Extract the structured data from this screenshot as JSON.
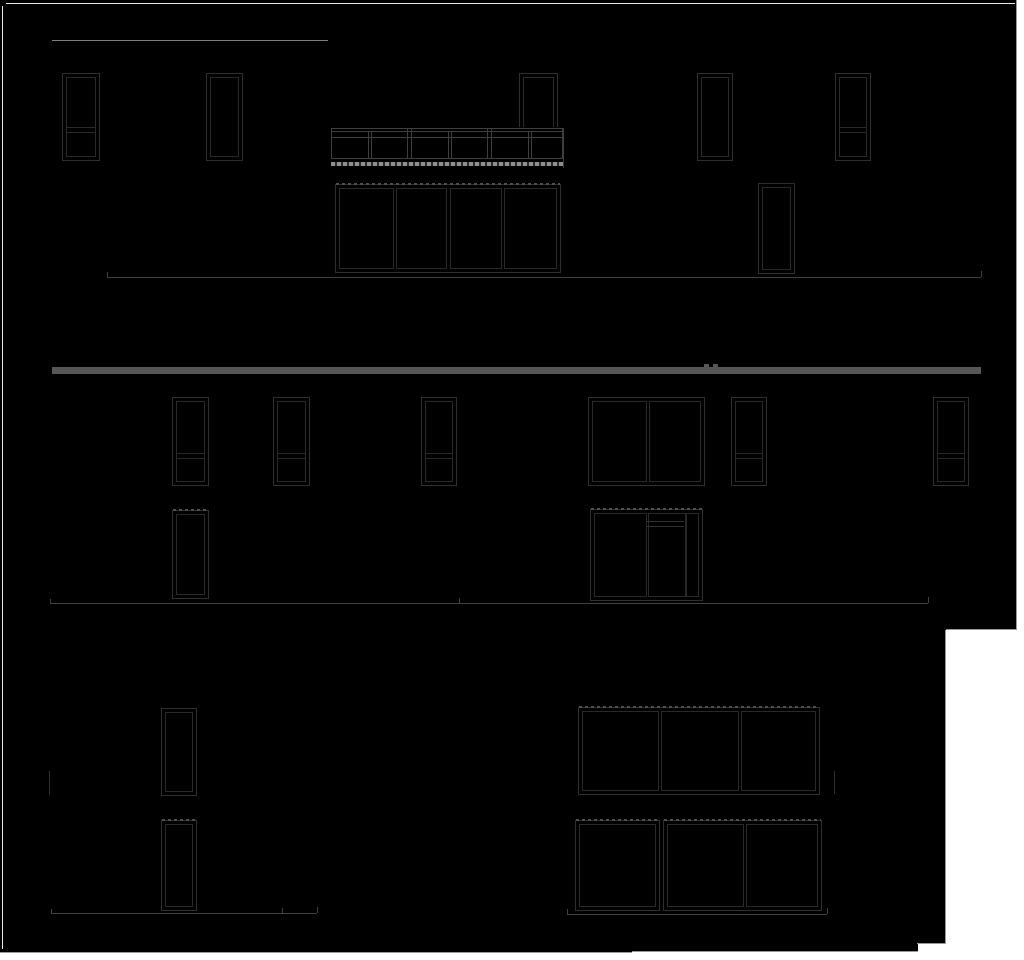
{
  "canvas": {
    "width": 1024,
    "height": 960,
    "page_bg": "#ffffff",
    "sheet_bg": "#000000"
  },
  "colors": {
    "frame": "#2f2f2f",
    "inner": "#292929",
    "ground": "#404040",
    "rail": "#3e3e3e",
    "bar": "#565656",
    "topline": "#7d7d7d",
    "border": "#e9e9e9",
    "edge": "#999999",
    "dash_light": "#8f8f8f",
    "dash_dark": "#2a2a2a",
    "hatch": "#4f4f4f"
  },
  "sheets": [
    {
      "name": "sheet-black-upper",
      "x": 0,
      "y": 0,
      "w": 1017,
      "h": 630
    },
    {
      "name": "sheet-black-lower",
      "x": 0,
      "y": 630,
      "w": 946,
      "h": 313
    },
    {
      "name": "sheet-black-lower-step1",
      "x": 0,
      "y": 943,
      "w": 918,
      "h": 9
    },
    {
      "name": "sheet-black-lower-step2",
      "x": 0,
      "y": 945,
      "w": 632,
      "h": 8
    }
  ],
  "page_edges": [
    {
      "name": "page-edge-right-upper",
      "type": "v",
      "x": 1016,
      "y": 0,
      "len": 630
    },
    {
      "name": "page-edge-bottom-upper",
      "type": "h",
      "x": 946,
      "y": 629,
      "len": 71
    },
    {
      "name": "page-edge-right-lower",
      "type": "v",
      "x": 945,
      "y": 630,
      "len": 313
    },
    {
      "name": "page-edge-step",
      "type": "h",
      "x": 917,
      "y": 943,
      "len": 29
    },
    {
      "name": "page-edge-bottom-strip",
      "type": "h",
      "x": 632,
      "y": 951,
      "len": 286
    },
    {
      "name": "page-edge-bottom-strip2",
      "type": "h",
      "x": 0,
      "y": 952,
      "len": 632
    }
  ],
  "sheet_border_lines": [
    {
      "name": "sheet-border-top",
      "type": "h",
      "x": 6,
      "y": 3,
      "len": 1009
    },
    {
      "name": "sheet-border-left",
      "type": "v",
      "x": 2,
      "y": 6,
      "len": 943
    }
  ],
  "elements": [
    {
      "type": "lineh",
      "name": "elev1-roof-line",
      "x": 52,
      "y": 40,
      "len": 276,
      "color": "topline"
    },
    {
      "type": "window",
      "name": "elev1-window-1",
      "x": 62,
      "y": 73,
      "w": 38,
      "h": 88,
      "transom": 0.6
    },
    {
      "type": "window",
      "name": "elev1-window-2",
      "x": 206,
      "y": 73,
      "w": 37,
      "h": 88
    },
    {
      "type": "window",
      "name": "elev1-window-behind-railing",
      "x": 519,
      "y": 73,
      "w": 39,
      "h": 88
    },
    {
      "type": "window",
      "name": "elev1-window-3",
      "x": 697,
      "y": 73,
      "w": 36,
      "h": 88
    },
    {
      "type": "window",
      "name": "elev1-window-4",
      "x": 835,
      "y": 73,
      "w": 36,
      "h": 88,
      "transom": 0.6
    },
    {
      "type": "railing",
      "name": "elev1-balcony-railing",
      "x": 331,
      "y": 127,
      "w": 233,
      "h": 41,
      "panels": 3
    },
    {
      "type": "window",
      "name": "elev1-sliding-door",
      "x": 335,
      "y": 184,
      "w": 226,
      "h": 89,
      "hatchTop": true,
      "mullions": [
        {
          "x": 57,
          "w": 4
        },
        {
          "x": 110,
          "w": 5
        },
        {
          "x": 165,
          "w": 4
        }
      ]
    },
    {
      "type": "window",
      "name": "elev1-door",
      "x": 758,
      "y": 183,
      "w": 37,
      "h": 91
    },
    {
      "type": "ground",
      "name": "elev1-ground-line",
      "x": 107,
      "y": 277,
      "len": 874,
      "ticks": [
        {
          "x": 0,
          "h": 5
        },
        {
          "x": 874,
          "h": 6
        }
      ]
    },
    {
      "type": "rect",
      "name": "elev2-parapet-bar",
      "x": 52,
      "y": 367,
      "w": 929,
      "h": 7,
      "color": "bar"
    },
    {
      "type": "rect",
      "name": "elev2-parapet-tab-1",
      "x": 704,
      "y": 364,
      "w": 5,
      "h": 3,
      "color": "bar"
    },
    {
      "type": "rect",
      "name": "elev2-parapet-tab-2",
      "x": 713,
      "y": 364,
      "w": 5,
      "h": 3,
      "color": "bar"
    },
    {
      "type": "window",
      "name": "elev2-window-1",
      "x": 172,
      "y": 397,
      "w": 37,
      "h": 89,
      "transom": 0.62
    },
    {
      "type": "window",
      "name": "elev2-window-2",
      "x": 273,
      "y": 397,
      "w": 37,
      "h": 89,
      "transom": 0.62
    },
    {
      "type": "window",
      "name": "elev2-window-3",
      "x": 421,
      "y": 397,
      "w": 36,
      "h": 89,
      "transom": 0.62
    },
    {
      "type": "window",
      "name": "elev2-double-window",
      "x": 588,
      "y": 397,
      "w": 117,
      "h": 89,
      "mullions": [
        {
          "x": 57,
          "w": 4
        }
      ]
    },
    {
      "type": "window",
      "name": "elev2-window-4",
      "x": 731,
      "y": 397,
      "w": 36,
      "h": 89,
      "transom": 0.62
    },
    {
      "type": "window",
      "name": "elev2-window-5",
      "x": 933,
      "y": 397,
      "w": 36,
      "h": 89,
      "transom": 0.62
    },
    {
      "type": "window",
      "name": "elev2-door",
      "x": 172,
      "y": 510,
      "w": 37,
      "h": 89,
      "hatchTop": true
    },
    {
      "type": "window",
      "name": "elev2-entry-combo",
      "x": 590,
      "y": 509,
      "w": 113,
      "h": 92,
      "hatchTop": true,
      "mullions": [
        {
          "x": 55,
          "w": 3
        },
        {
          "x": 94,
          "w": 2
        }
      ]
    },
    {
      "type": "lineh",
      "name": "elev2-entry-transom-line-1",
      "x": 647,
      "y": 521,
      "len": 37,
      "color": "frame"
    },
    {
      "type": "lineh",
      "name": "elev2-entry-transom-line-2",
      "x": 647,
      "y": 526,
      "len": 37,
      "color": "frame"
    },
    {
      "type": "ground",
      "name": "elev2-ground-line",
      "x": 50,
      "y": 603,
      "len": 878,
      "ticks": [
        {
          "x": 0,
          "h": 4
        },
        {
          "x": 409,
          "h": 5
        },
        {
          "x": 878,
          "h": 6
        }
      ]
    },
    {
      "type": "linev",
      "name": "elev3-wall-mark-left",
      "x": 49,
      "y": 771,
      "len": 24,
      "color": "frame"
    },
    {
      "type": "window",
      "name": "elev3-window-1",
      "x": 161,
      "y": 708,
      "w": 36,
      "h": 88
    },
    {
      "type": "window",
      "name": "elev3-door",
      "x": 161,
      "y": 820,
      "w": 36,
      "h": 91,
      "hatchTop": true
    },
    {
      "type": "window",
      "name": "elev3-triple-window",
      "x": 578,
      "y": 707,
      "w": 242,
      "h": 88,
      "hatchTop": true,
      "mullions": [
        {
          "x": 79,
          "w": 4
        },
        {
          "x": 159,
          "w": 4
        }
      ]
    },
    {
      "type": "linev",
      "name": "elev3-wall-mark-right",
      "x": 834,
      "y": 771,
      "len": 23,
      "color": "frame"
    },
    {
      "type": "window",
      "name": "elev3-window-2",
      "x": 575,
      "y": 820,
      "w": 85,
      "h": 91,
      "hatchTop": true
    },
    {
      "type": "window",
      "name": "elev3-slider",
      "x": 663,
      "y": 820,
      "w": 159,
      "h": 91,
      "hatchTop": true,
      "mullions": [
        {
          "x": 79,
          "w": 4
        }
      ]
    },
    {
      "type": "ground",
      "name": "elev3-ground-line-left",
      "x": 51,
      "y": 913,
      "len": 266,
      "ticks": [
        {
          "x": 0,
          "h": 4
        },
        {
          "x": 231,
          "h": 5
        },
        {
          "x": 266,
          "h": 6
        }
      ]
    },
    {
      "type": "ground",
      "name": "elev3-ground-line-right",
      "x": 567,
      "y": 914,
      "len": 260,
      "ticks": [
        {
          "x": 0,
          "h": 5
        },
        {
          "x": 260,
          "h": 6
        }
      ]
    }
  ]
}
